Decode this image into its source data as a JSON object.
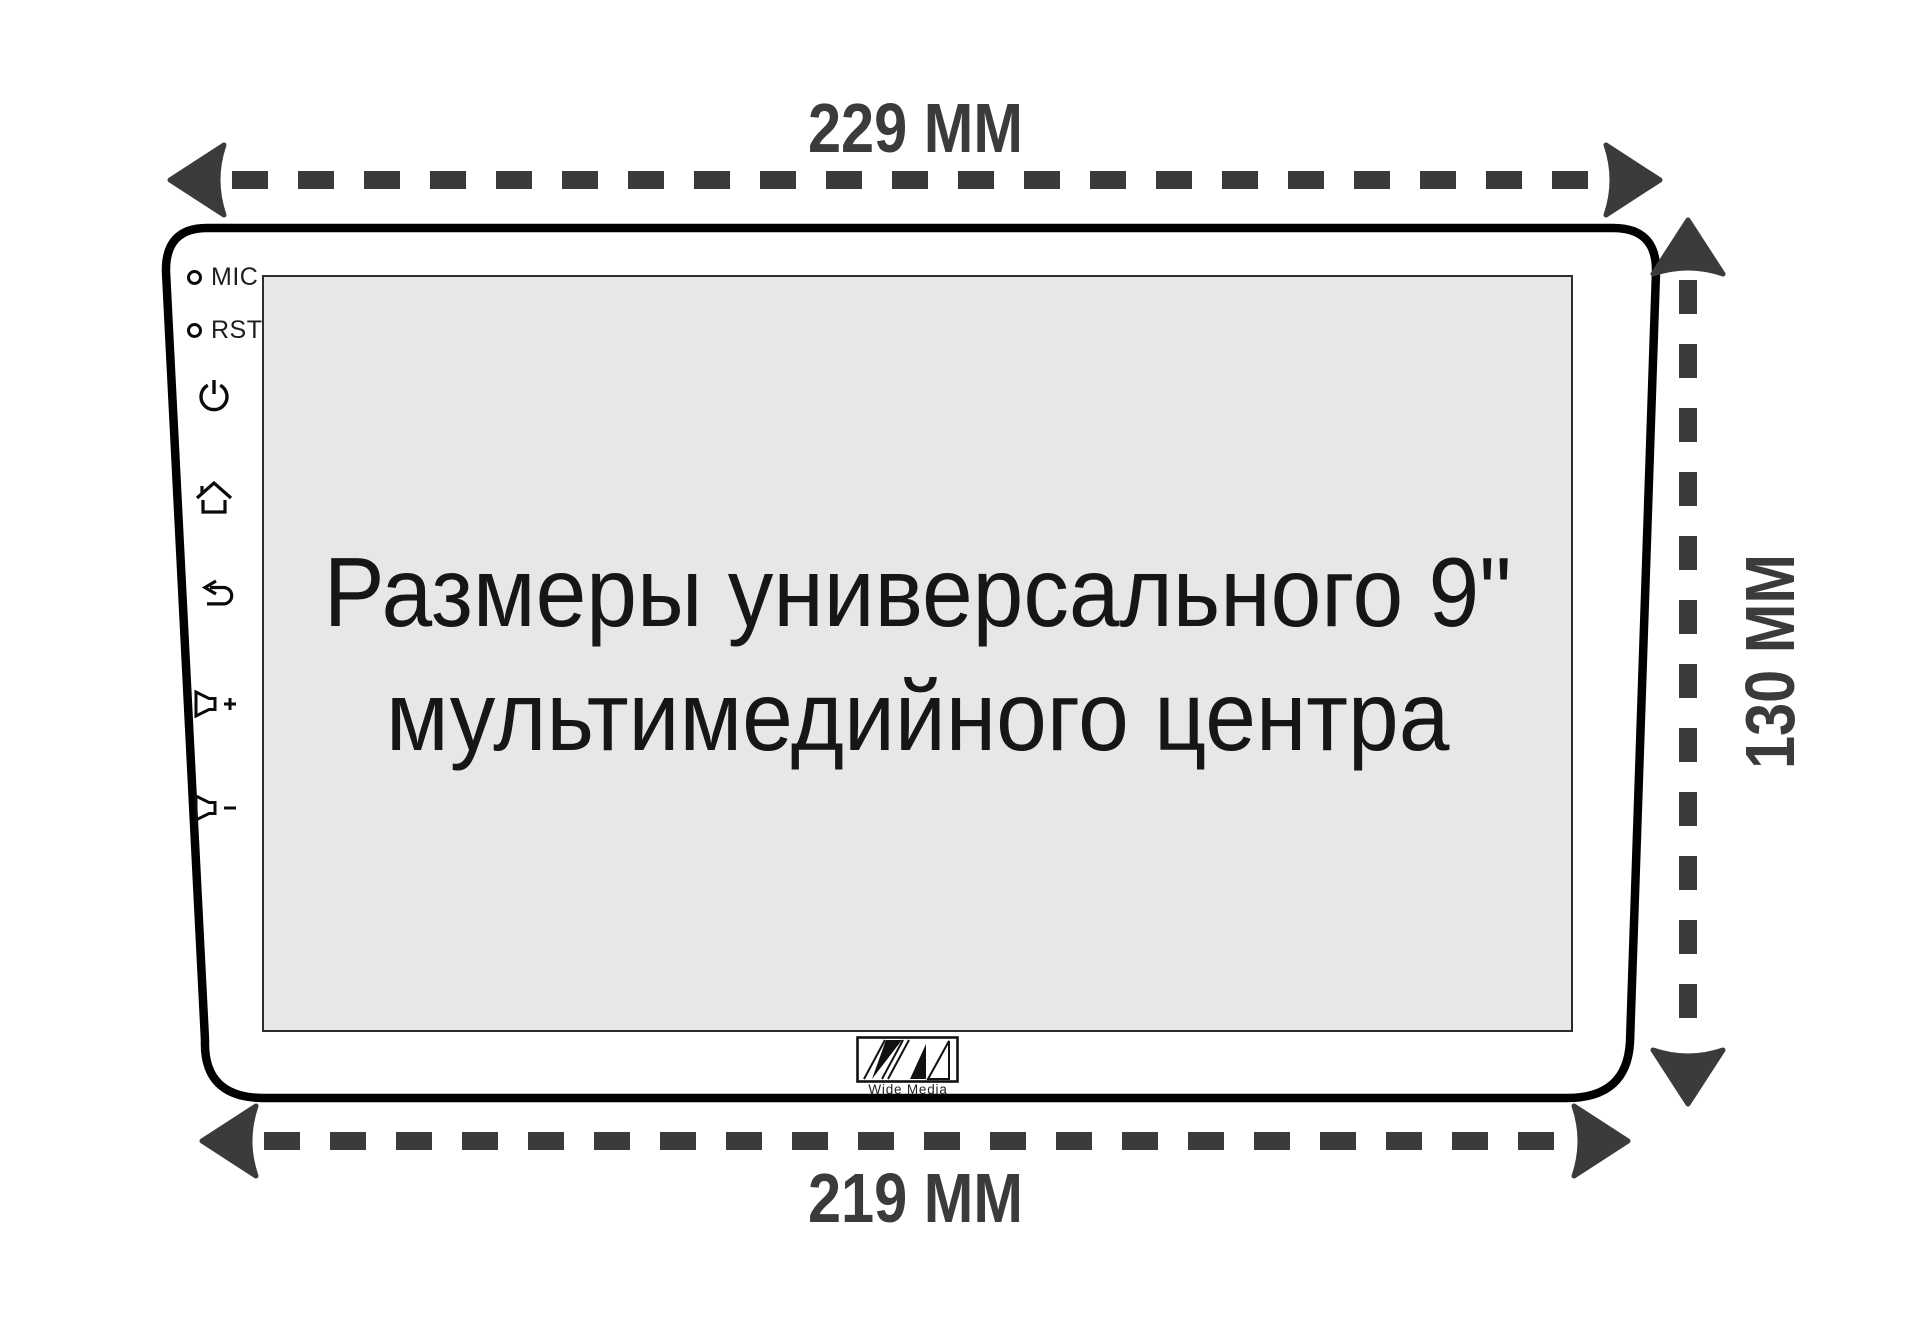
{
  "title": "Universal 9-inch multimedia head unit dimensions diagram",
  "dimensions": {
    "top": {
      "label": "229 ММ",
      "value": 229,
      "unit": "ММ"
    },
    "bottom": {
      "label": "219 ММ",
      "value": 219,
      "unit": "ММ"
    },
    "right": {
      "label": "130 ММ",
      "value": 130,
      "unit": "ММ"
    }
  },
  "device": {
    "screen": {
      "line1": "Размеры универсального 9\"",
      "line2": "мультимедийного центра"
    },
    "controls": [
      {
        "id": "mic",
        "label": "MIC",
        "icon": "mic-hole-icon"
      },
      {
        "id": "rst",
        "label": "RST",
        "icon": "reset-hole-icon"
      },
      {
        "id": "power",
        "label": "",
        "icon": "power-icon"
      },
      {
        "id": "home",
        "label": "",
        "icon": "home-icon"
      },
      {
        "id": "back",
        "label": "",
        "icon": "back-arrow-icon"
      },
      {
        "id": "volume-up",
        "label": "",
        "icon": "volume-plus-icon"
      },
      {
        "id": "volume-down",
        "label": "",
        "icon": "volume-minus-icon"
      }
    ],
    "brand": "Wide Media"
  },
  "colors": {
    "dimension_arrows": "#3b3b3b",
    "device_outline": "#000000",
    "screen_fill": "#e7e7e7",
    "screen_border": "#2d2d2d",
    "icon_stroke": "#0a0a0a",
    "caption_text": "#161616",
    "background": "#ffffff"
  }
}
